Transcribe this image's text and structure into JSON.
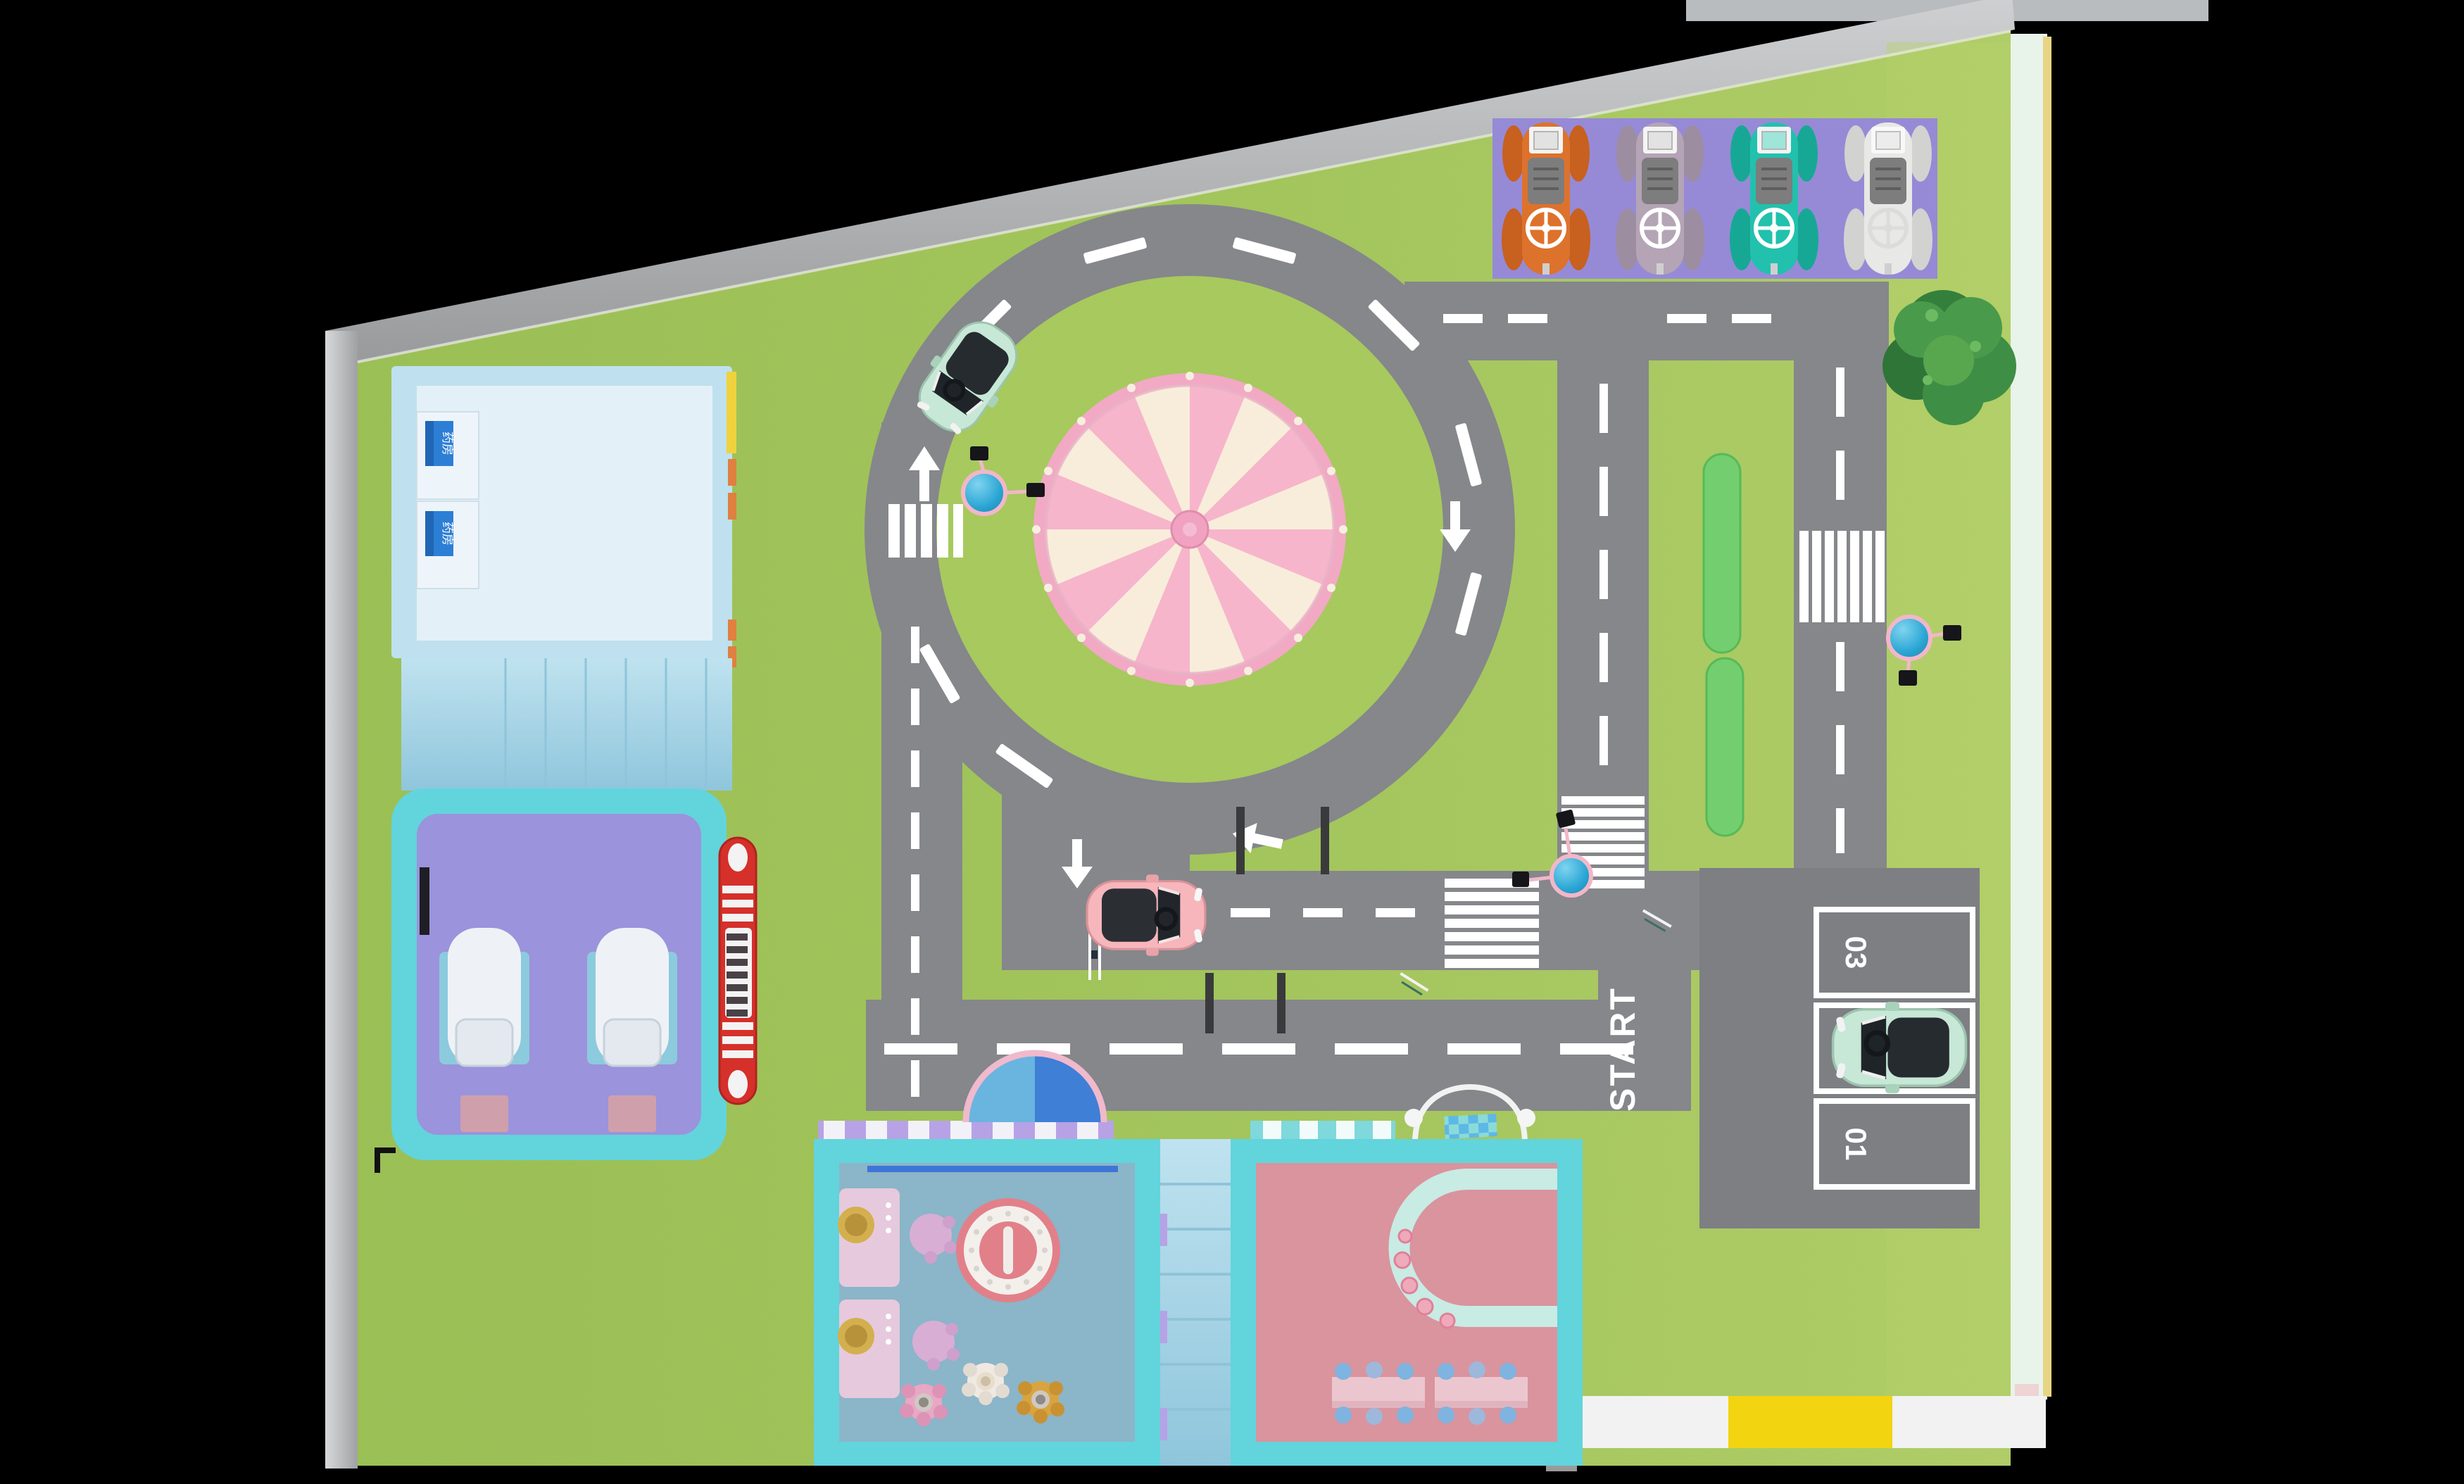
{
  "labels": {
    "start": "START"
  },
  "parking_bays": [
    "03",
    "02",
    "01"
  ],
  "signs": {
    "pharmacy_cabinet_1": "药房",
    "pharmacy_cabinet_2": "药房"
  },
  "colors": {
    "background": "#000000",
    "grass": "#a2c45c",
    "grass_island": "#a9cb60",
    "road": "#85878b",
    "parking_lot": "#7d7f83",
    "marking_white": "#ffffff",
    "parking_mat_purple": "#968ad6",
    "carousel_rim_pink": "#f2a9c4",
    "carousel_wedge_pink": "#f6b5cb",
    "carousel_cream": "#f8edda",
    "room_border_cyan": "#62d4dc",
    "room_floor_purple": "#9b93dc",
    "room_floor_blue": "#8bb5c8",
    "room_floor_pink": "#d9949e",
    "building_roof_blue": "#bfe0ee",
    "stair_blue": "#a9d6e6",
    "car_orange": "#dd722c",
    "car_mauve": "#b4a4b6",
    "car_teal": "#21c1ad",
    "car_white": "#e8e8e6",
    "car_mint": "#c7e8d6",
    "car_pink": "#f6b6bc",
    "lamp_blue": "#2ba6d4",
    "hedge_green": "#72ce6e",
    "tree_green": "#3e8e45",
    "bus_red": "#d6302a",
    "mat_yellow": "#f2d410",
    "wall_gray": "#c2c3c5",
    "wall_mint": "#e8f3ea",
    "awning_purple": "#b7a2e6",
    "awning_teal": "#7fd8dc",
    "pharmacy_sign_blue": "#2d7fd6"
  }
}
